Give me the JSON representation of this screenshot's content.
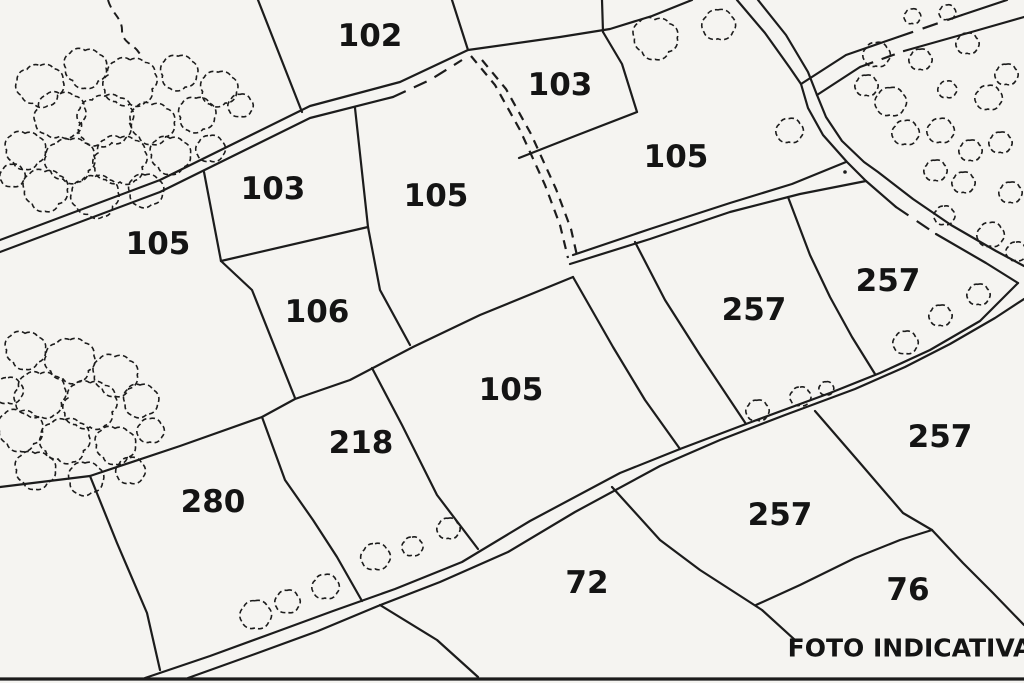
{
  "map": {
    "title_note": "FOTO INDICATIVA",
    "background": "#f5f4f1",
    "line_color": "#1c1c1c",
    "parcel_labels": [
      {
        "text": "102",
        "x": 370,
        "y": 36,
        "size": 31
      },
      {
        "text": "103",
        "x": 560,
        "y": 85,
        "size": 31
      },
      {
        "text": "105",
        "x": 676,
        "y": 157,
        "size": 31
      },
      {
        "text": "103",
        "x": 273,
        "y": 189,
        "size": 31
      },
      {
        "text": "105",
        "x": 436,
        "y": 196,
        "size": 31
      },
      {
        "text": "105",
        "x": 158,
        "y": 244,
        "size": 31
      },
      {
        "text": "257",
        "x": 888,
        "y": 281,
        "size": 31
      },
      {
        "text": "257",
        "x": 754,
        "y": 310,
        "size": 31
      },
      {
        "text": "106",
        "x": 317,
        "y": 312,
        "size": 31
      },
      {
        "text": "105",
        "x": 511,
        "y": 390,
        "size": 31
      },
      {
        "text": "218",
        "x": 361,
        "y": 443,
        "size": 31
      },
      {
        "text": "257",
        "x": 940,
        "y": 437,
        "size": 31
      },
      {
        "text": "280",
        "x": 213,
        "y": 502,
        "size": 31
      },
      {
        "text": "257",
        "x": 780,
        "y": 515,
        "size": 31
      },
      {
        "text": "72",
        "x": 587,
        "y": 583,
        "size": 31
      },
      {
        "text": "76",
        "x": 908,
        "y": 590,
        "size": 31
      }
    ],
    "footer_label": {
      "text": "FOTO INDICATIVA",
      "x": 910,
      "y": 648,
      "size": 25
    },
    "boundaries": [
      {
        "d": "M0,240 L160,180 L310,106 L400,82 L468,50 L560,37 L610,29 L652,16 L692,0",
        "w": 2.2
      },
      {
        "d": "M0,252 L160,192 L310,118 L393,97",
        "w": 2.2
      },
      {
        "d": "M737,0 L765,33 L790,68 L801,84",
        "w": 2.2
      },
      {
        "d": "M758,0 L786,35 L808,72 L817,95",
        "w": 2.2
      },
      {
        "d": "M801,84 L846,55 L898,37",
        "w": 2.2
      },
      {
        "d": "M962,15 L1007,0",
        "w": 2.2
      },
      {
        "d": "M817,95 L860,67",
        "w": 2.2
      },
      {
        "d": "M904,51 L975,31 L1024,17",
        "w": 2.2
      },
      {
        "d": "M801,84 L808,108 L823,135 L847,162 L866,181 L896,207",
        "w": 2.2
      },
      {
        "d": "M936,234 L986,263 L1018,283",
        "w": 2.2
      },
      {
        "d": "M817,95 L826,117 L842,141 L864,162 L878,172 L913,199 L951,225 L996,251 L1024,266",
        "w": 2.2
      },
      {
        "d": "M573,255 L650,229 L730,203 L792,184 L846,162",
        "w": 2.2
      },
      {
        "d": "M570,264 L650,239 L730,212 L800,194 L866,181",
        "w": 2.2
      },
      {
        "d": "M145,678 L210,656 L273,633 L333,611 L395,589 L462,562 L530,521 L620,473 L680,449 L746,424 L830,393 L880,373 L930,350 L980,321 L1018,283",
        "w": 2.2
      },
      {
        "d": "M188,678 L255,654 L318,631 L378,606 L440,582 L508,552 L575,512 L660,466 L720,440 L785,415 L855,389 L905,367 L950,344 L995,318 L1024,299",
        "w": 2.2
      },
      {
        "d": "M0,487 L90,476 L180,446 L262,417 L295,399 L350,380 L413,347 L480,315 L573,277",
        "w": 2.2
      },
      {
        "d": "M90,476 L117,543 L147,613 L160,670",
        "w": 2.2
      },
      {
        "d": "M262,417 L285,480 L313,520 L337,557 L362,601",
        "w": 2.2
      },
      {
        "d": "M372,368 L402,425 L437,495 L478,549",
        "w": 2.2
      },
      {
        "d": "M573,277 L613,347 L645,400 L680,449",
        "w": 2.2
      },
      {
        "d": "M635,242 L665,300 L700,355 L746,424",
        "w": 2.2
      },
      {
        "d": "M788,197 L810,255 L830,297 L852,337 L875,374",
        "w": 2.2
      },
      {
        "d": "M380,605 L437,640 L478,677",
        "w": 2.2
      },
      {
        "d": "M612,487 L660,540 L700,570 L745,599 L762,610 L795,640",
        "w": 2.2
      },
      {
        "d": "M756,605 L800,585 L855,558 L900,540 L932,530",
        "w": 2.2
      },
      {
        "d": "M815,411 L860,463 L903,513 L932,530 L963,563 L993,593 L1024,625",
        "w": 2.2
      },
      {
        "d": "M258,0 L302,112",
        "w": 2.2
      },
      {
        "d": "M452,0 L468,50",
        "w": 2.2
      },
      {
        "d": "M602,0 L603,32",
        "w": 2.2
      },
      {
        "d": "M603,32 L622,64 L637,112",
        "w": 2.2
      },
      {
        "d": "M637,112 L575,136 L519,158",
        "w": 2.2
      },
      {
        "d": "M204,172 L221,261",
        "w": 2.2
      },
      {
        "d": "M355,108 L368,227",
        "w": 2.2
      },
      {
        "d": "M221,261 L368,227",
        "w": 2.2
      },
      {
        "d": "M221,261 L252,290 L295,398",
        "w": 2.2
      },
      {
        "d": "M368,227 L380,290 L410,345",
        "w": 2.2
      },
      {
        "d": "M0,679 L1024,679",
        "w": 3.2
      }
    ],
    "dashed_paths": [
      {
        "d": "M393,97 L430,80 L462,60",
        "dash": "14 9",
        "w": 2.2
      },
      {
        "d": "M898,37 L962,15",
        "dash": "16 10",
        "w": 2.2
      },
      {
        "d": "M860,67 L904,51",
        "dash": "14 9",
        "w": 2.2
      },
      {
        "d": "M896,207 L936,234",
        "dash": "15 10",
        "w": 2.2
      },
      {
        "d": "M471,56 L495,85 L520,130 L545,185 L560,225 L568,258",
        "dash": "9 7",
        "w": 2.2
      },
      {
        "d": "M482,60 L506,89 L531,134 L556,189 L571,229 L578,260",
        "dash": "9 7",
        "w": 2.2
      },
      {
        "d": "M108,0 C112,14 122,18 122,30 C122,42 132,44 137,50 L143,58",
        "dash": "8 6",
        "w": 2.0
      }
    ],
    "bushes": [
      [
        40,
        85,
        22
      ],
      [
        85,
        68,
        20
      ],
      [
        130,
        82,
        25
      ],
      [
        178,
        72,
        18
      ],
      [
        218,
        88,
        18
      ],
      [
        60,
        115,
        24
      ],
      [
        105,
        120,
        27
      ],
      [
        152,
        123,
        21
      ],
      [
        196,
        114,
        18
      ],
      [
        240,
        105,
        12
      ],
      [
        25,
        150,
        19
      ],
      [
        70,
        160,
        23
      ],
      [
        120,
        160,
        25
      ],
      [
        170,
        155,
        19
      ],
      [
        210,
        148,
        14
      ],
      [
        45,
        190,
        21
      ],
      [
        95,
        196,
        22
      ],
      [
        145,
        190,
        17
      ],
      [
        12,
        175,
        12
      ],
      [
        655,
        38,
        21
      ],
      [
        718,
        24,
        16
      ],
      [
        789,
        130,
        13
      ],
      [
        912,
        16,
        8
      ],
      [
        947,
        12,
        8
      ],
      [
        876,
        54,
        13
      ],
      [
        920,
        59,
        11
      ],
      [
        967,
        43,
        11
      ],
      [
        1006,
        74,
        11
      ],
      [
        988,
        97,
        13
      ],
      [
        947,
        89,
        9
      ],
      [
        890,
        101,
        15
      ],
      [
        866,
        85,
        11
      ],
      [
        940,
        130,
        13
      ],
      [
        905,
        132,
        13
      ],
      [
        970,
        150,
        11
      ],
      [
        1000,
        142,
        11
      ],
      [
        935,
        170,
        11
      ],
      [
        963,
        182,
        11
      ],
      [
        1010,
        192,
        11
      ],
      [
        944,
        215,
        10
      ],
      [
        990,
        234,
        13
      ],
      [
        1016,
        251,
        10
      ],
      [
        255,
        614,
        15
      ],
      [
        287,
        601,
        12
      ],
      [
        325,
        586,
        13
      ],
      [
        375,
        556,
        14
      ],
      [
        412,
        546,
        10
      ],
      [
        448,
        528,
        11
      ],
      [
        757,
        410,
        11
      ],
      [
        800,
        396,
        10
      ],
      [
        826,
        388,
        7
      ],
      [
        905,
        342,
        12
      ],
      [
        940,
        315,
        11
      ],
      [
        978,
        294,
        11
      ],
      [
        25,
        350,
        19
      ],
      [
        70,
        360,
        23
      ],
      [
        115,
        375,
        21
      ],
      [
        40,
        395,
        24
      ],
      [
        90,
        405,
        25
      ],
      [
        140,
        400,
        17
      ],
      [
        20,
        430,
        21
      ],
      [
        65,
        440,
        23
      ],
      [
        115,
        445,
        19
      ],
      [
        150,
        430,
        13
      ],
      [
        35,
        470,
        19
      ],
      [
        85,
        478,
        17
      ],
      [
        130,
        470,
        14
      ],
      [
        8,
        390,
        14
      ]
    ],
    "dots": [
      [
        845,
        172
      ]
    ]
  }
}
